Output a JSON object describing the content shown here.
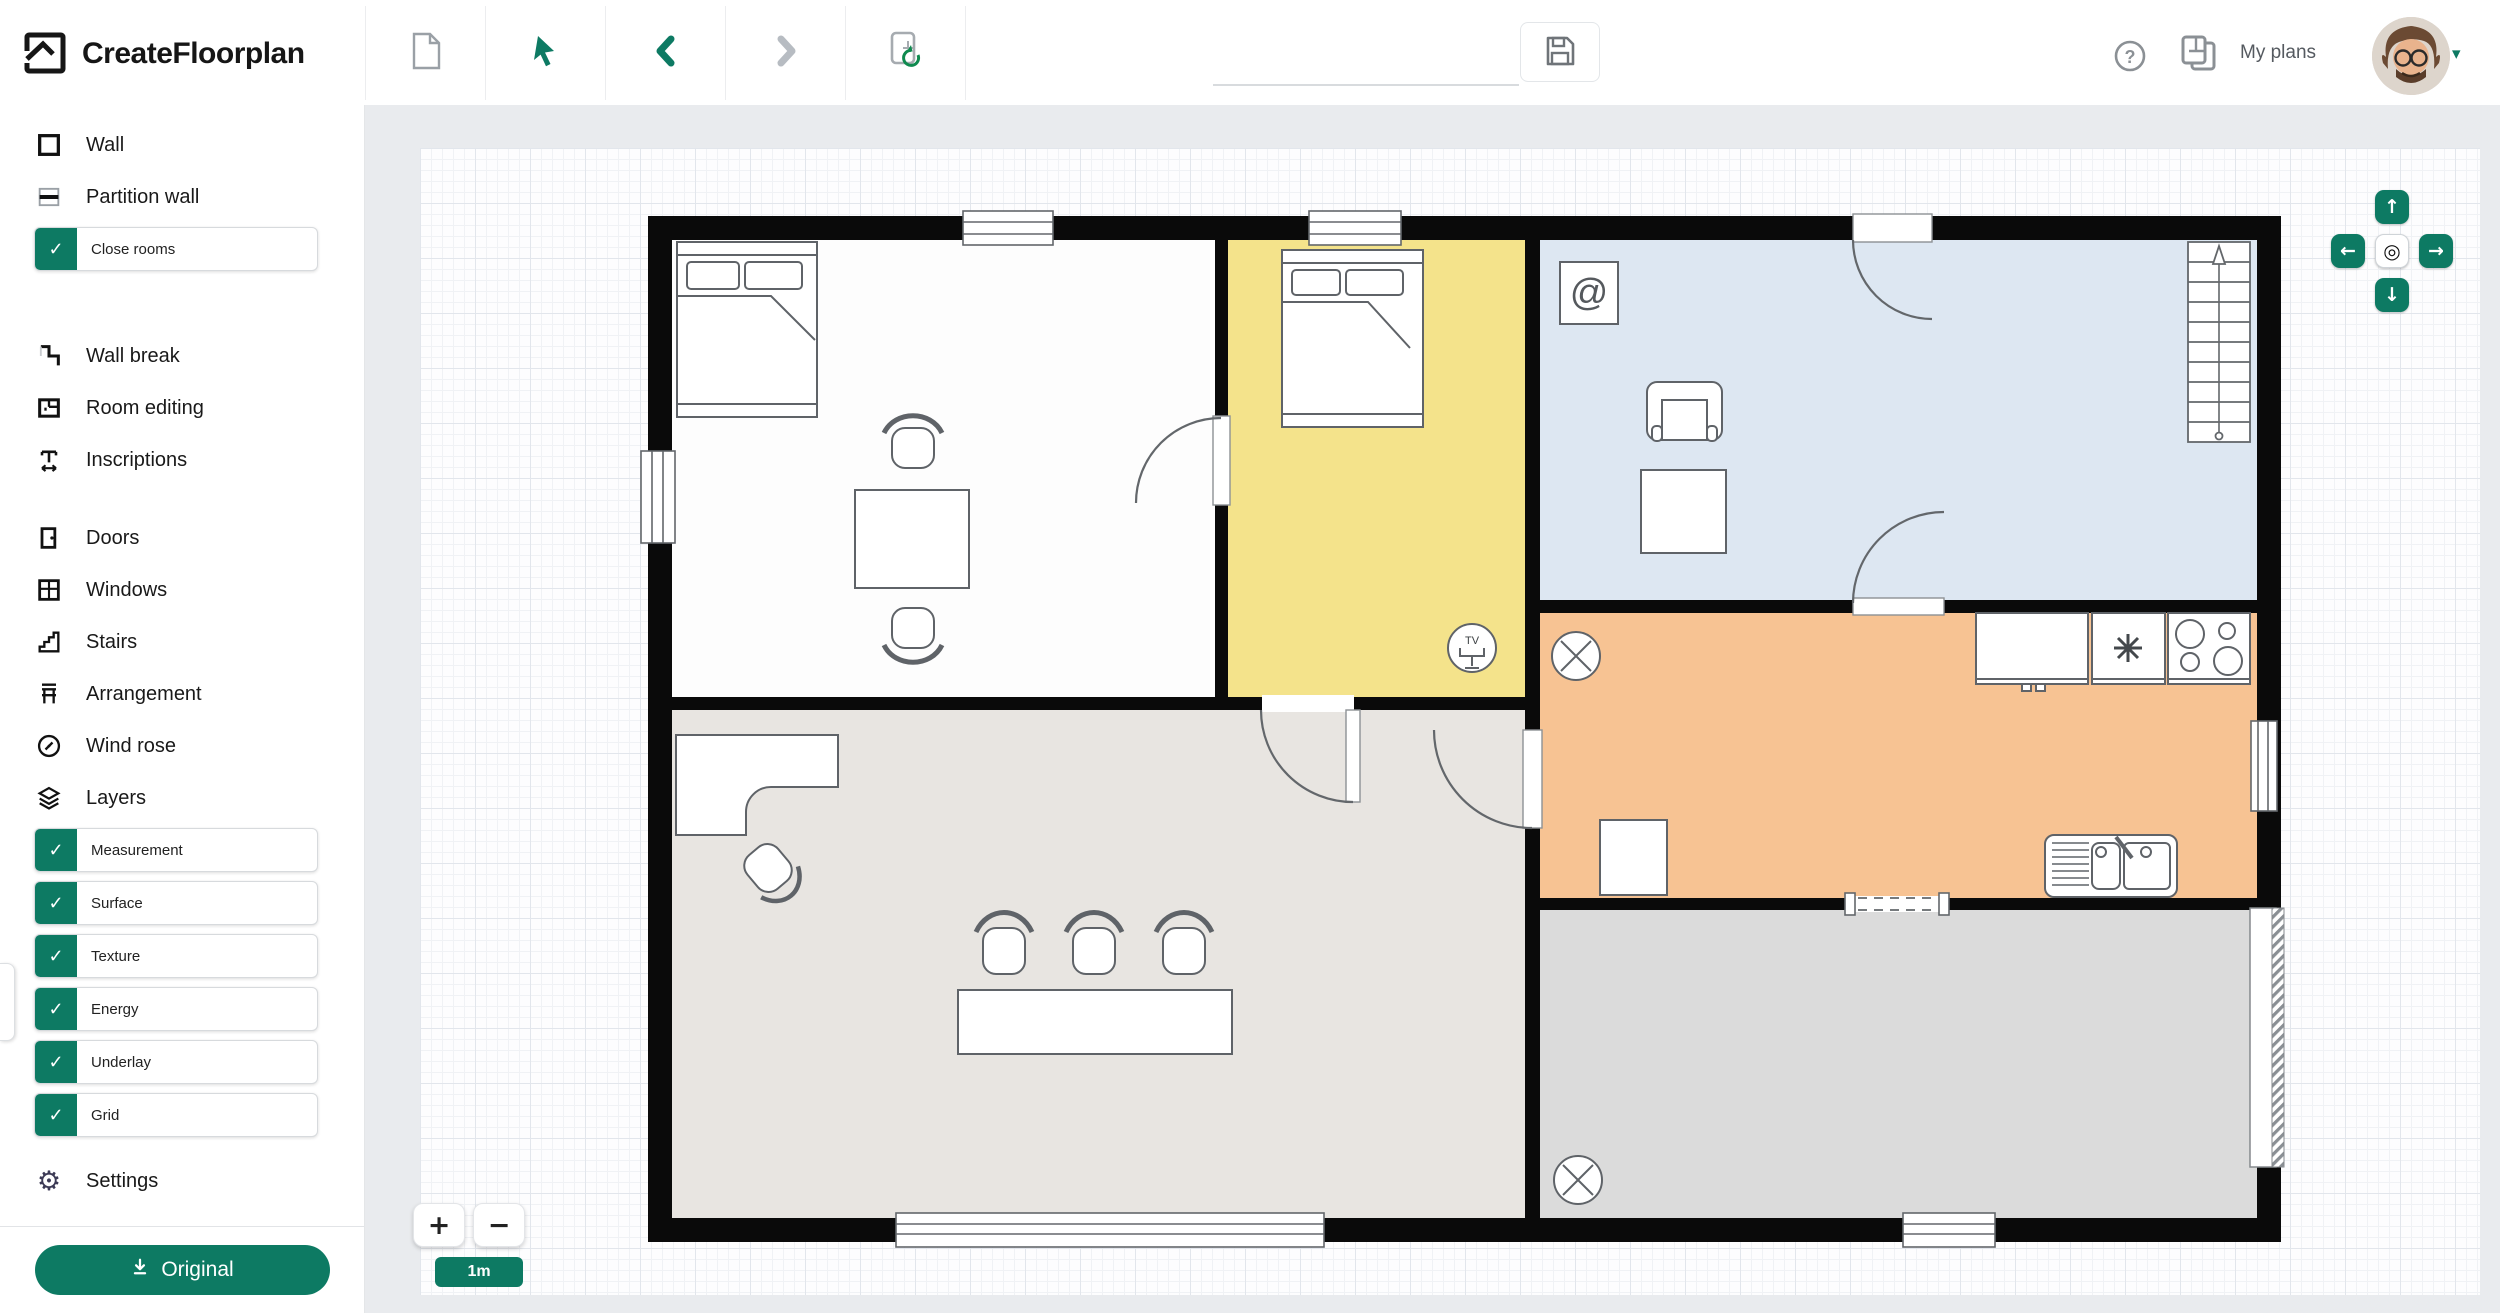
{
  "app": {
    "logo_text": "CreateFloorplan"
  },
  "topbar": {
    "tools": [
      {
        "icon": "new-plan-icon"
      },
      {
        "icon": "select-cursor-icon"
      },
      {
        "icon": "undo-icon"
      },
      {
        "icon": "redo-icon"
      },
      {
        "icon": "reload-plan-icon"
      }
    ],
    "plan_name": {
      "value": "",
      "placeholder": ""
    },
    "save_icon": "floppy-disk-icon",
    "help_glyph": "?",
    "my_plans_label": "My plans",
    "account_caret": "▾"
  },
  "sidebar": {
    "tools": [
      {
        "label": "Wall"
      },
      {
        "label": "Partition wall"
      },
      {
        "label": "Wall break"
      },
      {
        "label": "Room editing"
      },
      {
        "label": "Inscriptions"
      },
      {
        "label": "Doors"
      },
      {
        "label": "Windows"
      },
      {
        "label": "Stairs"
      },
      {
        "label": "Arrangement"
      },
      {
        "label": "Wind rose"
      },
      {
        "label": "Layers"
      },
      {
        "label": "Settings"
      }
    ],
    "close_rooms": {
      "label": "Close rooms",
      "checked": true
    },
    "layers": [
      {
        "label": "Measurement",
        "checked": true
      },
      {
        "label": "Surface",
        "checked": true
      },
      {
        "label": "Texture",
        "checked": true
      },
      {
        "label": "Energy",
        "checked": true
      },
      {
        "label": "Underlay",
        "checked": true
      },
      {
        "label": "Grid",
        "checked": true
      }
    ],
    "check_glyph": "✓",
    "download_label": "Original"
  },
  "canvas": {
    "scale_label": "1m",
    "zoom_in_glyph": "+",
    "zoom_out_glyph": "−",
    "nav": {
      "up": "↑",
      "left": "←",
      "right": "→",
      "down": "↓",
      "center": "◎"
    },
    "symbols": {
      "computer": "@",
      "tv": "TV"
    },
    "rooms": {
      "bedroom_white": "#fdfdfd",
      "bedroom_yellow": "#f4e38b",
      "living_blue": "#dde7f2",
      "kitchen_orange": "#f7c393",
      "office_beige": "#e8e5e1",
      "terrace_gray": "#dbdbdb"
    }
  },
  "colors": {
    "accent_teal": "#0d7a63",
    "wall_black": "#0a0a0a",
    "icon_gray": "#9aa0a6"
  }
}
